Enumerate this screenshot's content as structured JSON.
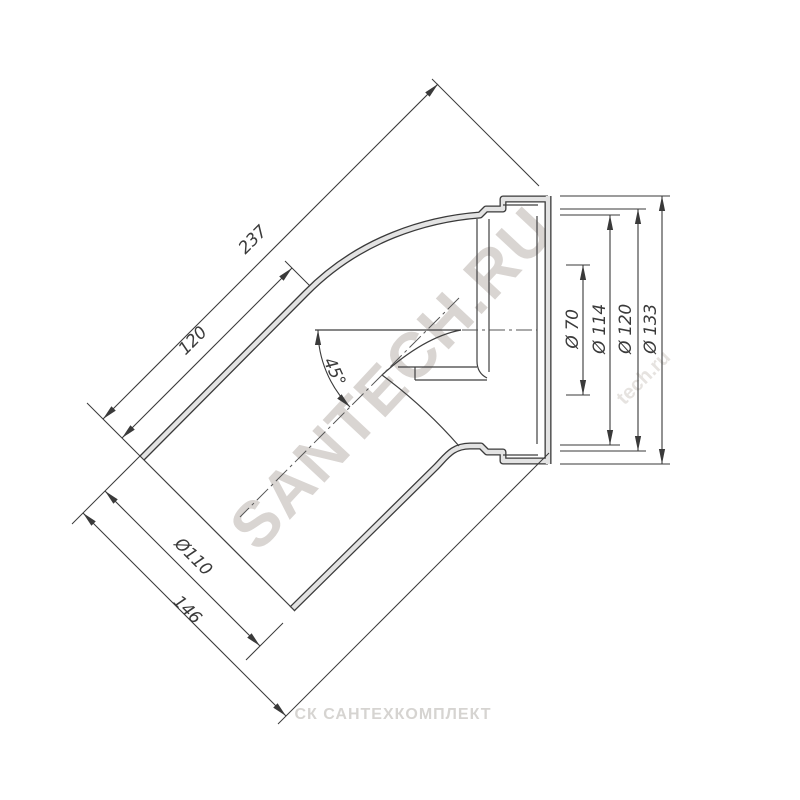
{
  "drawing": {
    "description": "Technical drawing of a 45-degree sanitary pipe elbow with socket",
    "angle_label": "45°",
    "dimensions": {
      "total_length": "237",
      "straight_length": "120",
      "pipe_od": "Ø110",
      "tail_length": "146",
      "inner_dia": "Ø 70",
      "socket_dia": "Ø 114",
      "groove_dia": "Ø 120",
      "flange_dia": "Ø 133"
    },
    "watermarks": {
      "diagonal": "SANTECH.RU",
      "small": "tech.ru",
      "bottom": "СК САНТЕХКОМПЛЕКТ"
    },
    "colors": {
      "line": "#3a3a3a",
      "wall_fill": "#e3e3e3",
      "watermark": "#d9d5d2"
    }
  }
}
